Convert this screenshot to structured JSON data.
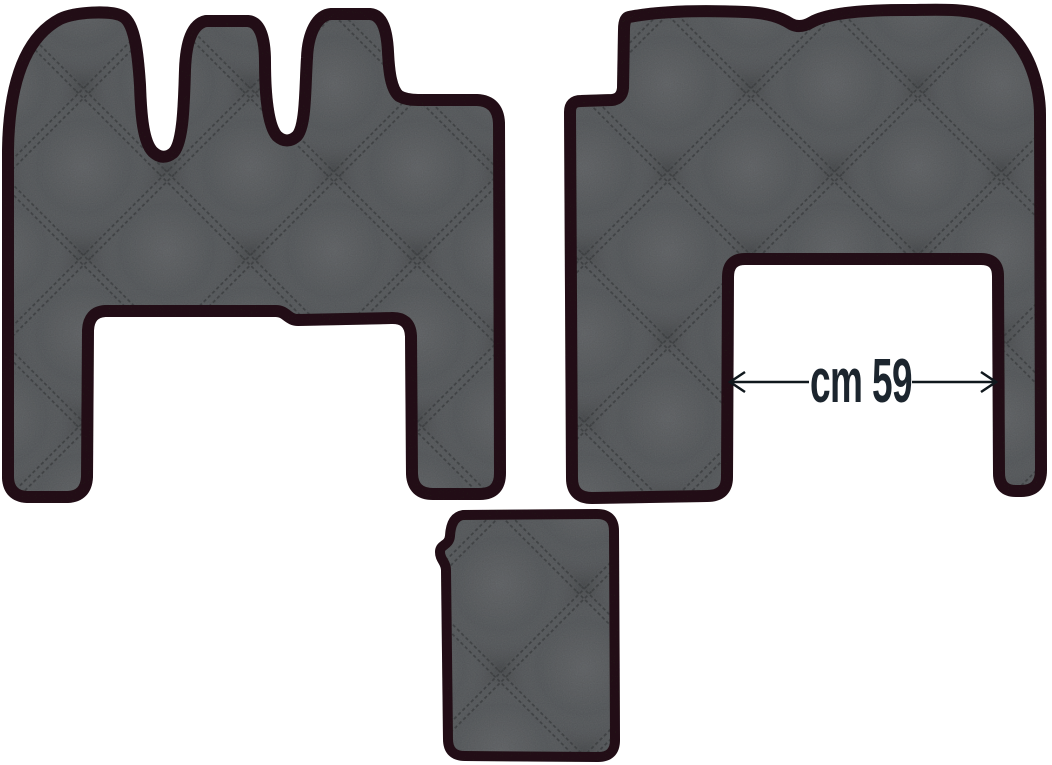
{
  "figure": {
    "annotation": {
      "dimension_label": "cm 59",
      "arrow": "double-headed-horizontal-arrow"
    },
    "mats": [
      {
        "name": "driver-floor-mat",
        "texture": "quilted-diamond-stitch"
      },
      {
        "name": "passenger-floor-mat",
        "texture": "quilted-diamond-stitch"
      },
      {
        "name": "engine-tunnel-mat",
        "texture": "quilted-diamond-stitch"
      }
    ]
  },
  "colors": {
    "background": "#ffffff",
    "mat_fill": "#5e6164",
    "mat_stitch": "#434548",
    "edging": "#261419",
    "dimension_text": "#1c252e",
    "arrow": "#10181d"
  }
}
